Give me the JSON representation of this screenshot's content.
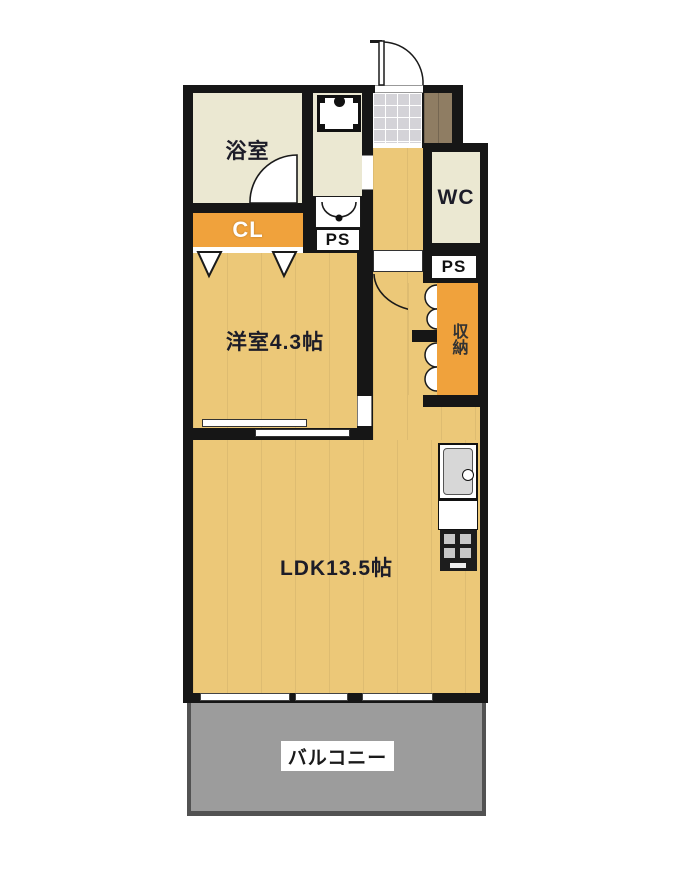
{
  "plan": {
    "type": "apartment-floor-plan",
    "rooms": {
      "bathroom": {
        "label": "浴室"
      },
      "closet": {
        "label": "CL"
      },
      "western_room": {
        "label": "洋室4.3帖"
      },
      "ldk": {
        "label": "LDK13.5帖"
      },
      "wc": {
        "label": "WC"
      },
      "storage": {
        "label": "収納"
      },
      "balcony": {
        "label": "バルコニー"
      },
      "pipe_space_washroom": {
        "label": "PS"
      },
      "pipe_space_hall": {
        "label": "PS"
      }
    },
    "colors": {
      "wall": "#161616",
      "wood": "#ecc878",
      "cream": "#ebe8d2",
      "orange": "#f0a23c",
      "balcony": "#9c9c9c",
      "tile": "#d4d3d8",
      "brown": "#8f7d63",
      "page": "#ffffff"
    }
  }
}
